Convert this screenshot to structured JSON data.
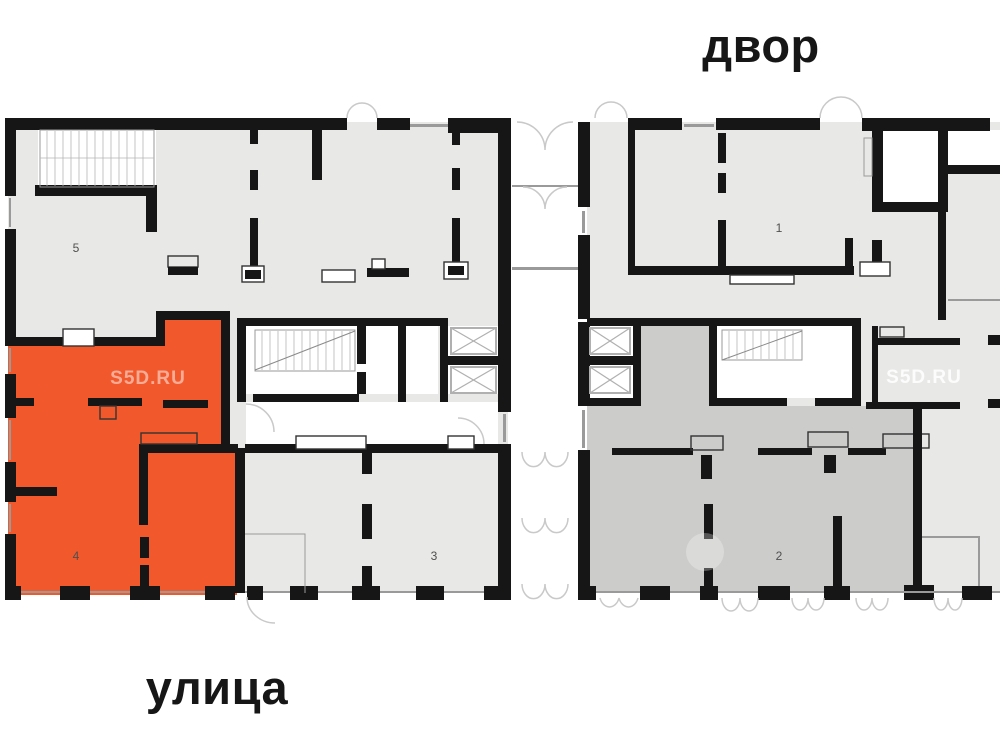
{
  "labels": {
    "courtyard": "двор",
    "street": "улица"
  },
  "units": {
    "unit1": {
      "number": "1",
      "highlighted": false
    },
    "unit2": {
      "number": "2",
      "highlighted": false
    },
    "unit3": {
      "number": "3",
      "highlighted": false
    },
    "unit4": {
      "number": "4",
      "highlighted": true
    },
    "unit5": {
      "number": "5",
      "highlighted": false
    }
  },
  "watermarks": {
    "left": "S5D.RU",
    "right": "S5D.RU"
  },
  "colors": {
    "page_bg": "#ffffff",
    "wall": "#161616",
    "floor_light": "#e8e8e6",
    "floor_mid": "#cccccb",
    "highlight": "#f1582c",
    "text": "#161616",
    "label": "#4f4f4f",
    "thin_line": "#9a9a9a",
    "arc": "#c9c9c9",
    "wm_on_orange": "rgba(255,255,255,0.5)",
    "wm_on_gray": "rgba(255,255,255,0.85)"
  }
}
